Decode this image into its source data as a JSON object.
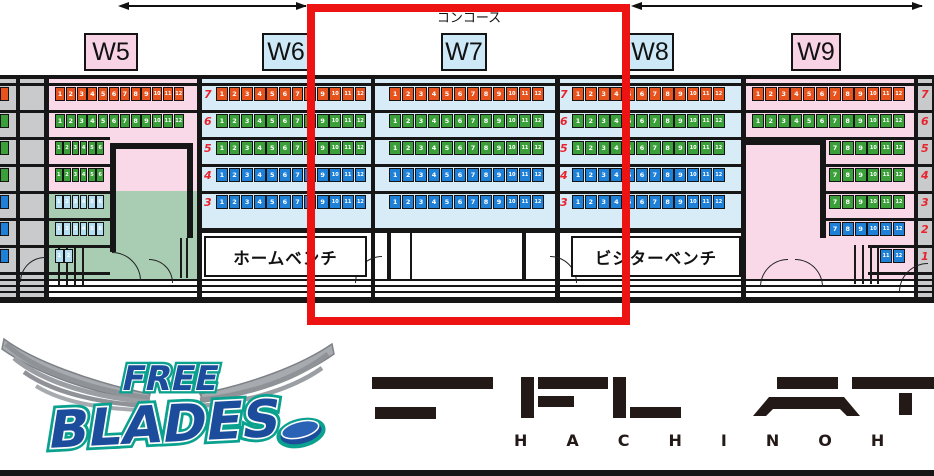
{
  "arena": {
    "concourse_label": "コンコース",
    "benches": {
      "home": "ホームベンチ",
      "visitor": "ビジターベンチ"
    },
    "right_rail_rows": [
      "7",
      "6",
      "5",
      "4",
      "3",
      "2",
      "1"
    ],
    "sections": [
      {
        "id": "left-edge",
        "label": "",
        "label_style": "",
        "rows": [
          {
            "row": "",
            "color": "orange",
            "seats": []
          },
          {
            "row": "",
            "color": "green",
            "seats": []
          },
          {
            "row": "",
            "color": "green",
            "seats": []
          },
          {
            "row": "",
            "color": "green",
            "seats": []
          },
          {
            "row": "",
            "color": "blue",
            "seats": []
          },
          {
            "row": "",
            "color": "blue",
            "seats": []
          },
          {
            "row": "",
            "color": "blue",
            "seats": []
          }
        ]
      },
      {
        "id": "W5",
        "label": "W5",
        "label_style": "pink",
        "rows": [
          {
            "row": "",
            "color": "orange",
            "seats": [
              1,
              2,
              3,
              4,
              5,
              6,
              7,
              8,
              9,
              10,
              11,
              12
            ]
          },
          {
            "row": "",
            "color": "green",
            "seats": [
              1,
              2,
              3,
              4,
              5,
              6,
              7,
              8,
              9,
              10,
              11,
              12
            ]
          },
          {
            "row": "",
            "color": "green",
            "seats": [
              1,
              2,
              3,
              4,
              5,
              6
            ]
          },
          {
            "row": "",
            "color": "green",
            "seats": [
              1,
              2,
              3,
              4,
              5,
              6
            ]
          },
          {
            "row": "",
            "color": "paleblue",
            "seats": [
              1,
              2,
              3,
              4,
              5,
              6
            ]
          },
          {
            "row": "",
            "color": "paleblue",
            "seats": [
              1,
              2,
              3,
              4,
              5,
              6
            ]
          },
          {
            "row": "",
            "color": "paleblue",
            "seats": [
              1,
              2
            ]
          }
        ]
      },
      {
        "id": "W6",
        "label": "W6",
        "label_style": "blue",
        "rows": [
          {
            "row": "7",
            "color": "orange",
            "seats": [
              1,
              2,
              3,
              4,
              5,
              6,
              7,
              8,
              9,
              10,
              11,
              12
            ]
          },
          {
            "row": "6",
            "color": "green",
            "seats": [
              1,
              2,
              3,
              4,
              5,
              6,
              7,
              8,
              9,
              10,
              11,
              12
            ]
          },
          {
            "row": "5",
            "color": "green",
            "seats": [
              1,
              2,
              3,
              4,
              5,
              6,
              7,
              8,
              9,
              10,
              11,
              12
            ]
          },
          {
            "row": "4",
            "color": "blue",
            "seats": [
              1,
              2,
              3,
              4,
              5,
              6,
              7,
              8,
              9,
              10,
              11,
              12
            ]
          },
          {
            "row": "3",
            "color": "blue",
            "seats": [
              1,
              2,
              3,
              4,
              5,
              6,
              7,
              8,
              9,
              10,
              11,
              12
            ]
          }
        ]
      },
      {
        "id": "W7",
        "label": "W7",
        "label_style": "blue",
        "rows": [
          {
            "row": "",
            "color": "orange",
            "seats": [
              1,
              2,
              3,
              4,
              5,
              6,
              7,
              8,
              9,
              10,
              11,
              12
            ]
          },
          {
            "row": "",
            "color": "green",
            "seats": [
              1,
              2,
              3,
              4,
              5,
              6,
              7,
              8,
              9,
              10,
              11,
              12
            ]
          },
          {
            "row": "",
            "color": "green",
            "seats": [
              1,
              2,
              3,
              4,
              5,
              6,
              7,
              8,
              9,
              10,
              11,
              12
            ]
          },
          {
            "row": "",
            "color": "blue",
            "seats": [
              1,
              2,
              3,
              4,
              5,
              6,
              7,
              8,
              9,
              10,
              11,
              12
            ]
          },
          {
            "row": "",
            "color": "blue",
            "seats": [
              1,
              2,
              3,
              4,
              5,
              6,
              7,
              8,
              9,
              10,
              11,
              12
            ]
          }
        ]
      },
      {
        "id": "W8",
        "label": "W8",
        "label_style": "blue",
        "rows": [
          {
            "row": "7",
            "color": "orange",
            "seats": [
              1,
              2,
              3,
              4,
              5,
              6,
              7,
              8,
              9,
              10,
              11,
              12
            ]
          },
          {
            "row": "6",
            "color": "green",
            "seats": [
              1,
              2,
              3,
              4,
              5,
              6,
              7,
              8,
              9,
              10,
              11,
              12
            ]
          },
          {
            "row": "5",
            "color": "green",
            "seats": [
              1,
              2,
              3,
              4,
              5,
              6,
              7,
              8,
              9,
              10,
              11,
              12
            ]
          },
          {
            "row": "4",
            "color": "blue",
            "seats": [
              1,
              2,
              3,
              4,
              5,
              6,
              7,
              8,
              9,
              10,
              11,
              12
            ]
          },
          {
            "row": "3",
            "color": "blue",
            "seats": [
              1,
              2,
              3,
              4,
              5,
              6,
              7,
              8,
              9,
              10,
              11,
              12
            ]
          }
        ]
      },
      {
        "id": "W9",
        "label": "W9",
        "label_style": "pink",
        "rows": [
          {
            "row": "",
            "color": "orange",
            "seats": [
              1,
              2,
              3,
              4,
              5,
              6,
              7,
              8,
              9,
              10,
              11,
              12
            ]
          },
          {
            "row": "",
            "color": "green",
            "seats": [
              1,
              2,
              3,
              4,
              5,
              6,
              7,
              8,
              9,
              10,
              11,
              12
            ]
          },
          {
            "row": "",
            "color": "green",
            "seats": [
              7,
              8,
              9,
              10,
              11,
              12
            ]
          },
          {
            "row": "",
            "color": "green",
            "seats": [
              7,
              8,
              9,
              10,
              11,
              12
            ]
          },
          {
            "row": "",
            "color": "green",
            "seats": [
              7,
              8,
              9,
              10,
              11,
              12
            ]
          },
          {
            "row": "",
            "color": "blue",
            "seats": [
              7,
              8,
              9,
              10,
              11,
              12
            ]
          },
          {
            "row": "",
            "color": "blue",
            "seats": [
              11,
              12
            ]
          }
        ]
      }
    ]
  },
  "logos": {
    "freeblades_line1": "FREE",
    "freeblades_line2": "BLADES",
    "flat_word": "HACHINOH"
  },
  "colors": {
    "orange": "#E8521D",
    "green": "#3BA039",
    "blue": "#1F80D8",
    "paleblue": "#B5DFF1",
    "pink_bg": "#F9D9E8",
    "blue_bg": "#D8ECF8",
    "green_bg": "#A9CDB2",
    "gray_bg": "#C9CACB",
    "label_pink": "#F8D2E5",
    "label_blue": "#CDE9F8",
    "red_highlight": "#EE1313",
    "row_number_red": "#E8232D",
    "line_black": "#161616",
    "flat_dark": "#231A17",
    "blades_blue": "#1C4C9C",
    "blades_teal": "#0BA18F",
    "wing_gray": "#9B9FA4"
  }
}
